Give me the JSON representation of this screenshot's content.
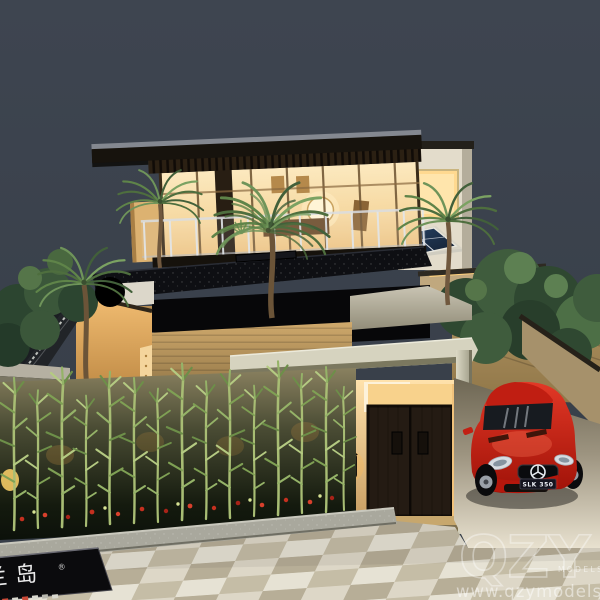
{
  "meta": {
    "title": "Night-lit architectural scale model of a modern two-storey villa"
  },
  "watermark": {
    "logo": "QZY",
    "logo_sub": "MODELS",
    "url": "www.qzymodels.com"
  },
  "car": {
    "plate": "SLK 350",
    "color": "#c8271b",
    "brand": "mercedes-star"
  },
  "sign": {
    "text": "兰岛",
    "reg": "®"
  },
  "colors": {
    "background": "#3b424c",
    "warm_glow": "#f7d9a2",
    "roof_dark": "#17130d",
    "wall_tan": "#c9a263",
    "canopy": "#d6d3bf",
    "foliage": "#3f5a38",
    "paving_light": "#ddd7c7",
    "paving_dark": "#b7ae97",
    "car_red": "#c8271b"
  }
}
